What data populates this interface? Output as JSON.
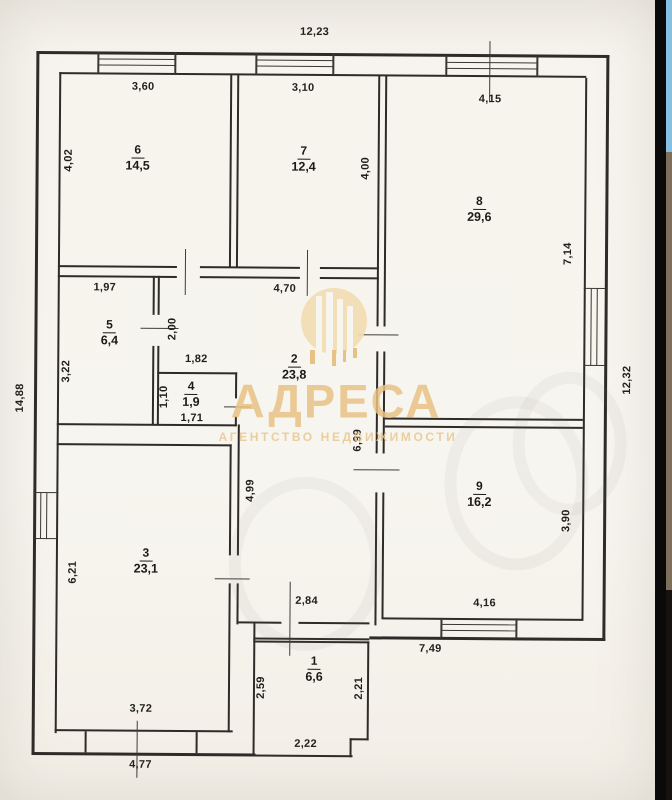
{
  "photo": {
    "type": "floor-plan-scan",
    "overall_dimensions": {
      "top": "12,23",
      "left": "14,88",
      "right": "12,32"
    }
  },
  "watermark": {
    "title": "АДРЕСА",
    "subtitle": "АГЕНТСТВО НЕДВИЖИМОСТИ",
    "color": "#e8c285",
    "disc": {
      "x": 301,
      "y": 288,
      "size": 66,
      "fill": "#f2ddb0"
    },
    "white_bars": [
      [
        316,
        296,
        6,
        72
      ],
      [
        326,
        292,
        7,
        76
      ],
      [
        337,
        299,
        6,
        69
      ],
      [
        347,
        306,
        6,
        62
      ]
    ],
    "gold_bars": [
      [
        310,
        350,
        5,
        14
      ],
      [
        332,
        350,
        4,
        16
      ],
      [
        343,
        350,
        3,
        12
      ],
      [
        353,
        348,
        4,
        10
      ]
    ]
  },
  "floor_plan": {
    "rooms": [
      {
        "number": "6",
        "area": "14,5",
        "x": 136,
        "y": 158
      },
      {
        "number": "7",
        "area": "12,4",
        "x": 302,
        "y": 158
      },
      {
        "number": "8",
        "area": "29,6",
        "x": 478,
        "y": 207
      },
      {
        "number": "5",
        "area": "6,4",
        "x": 109,
        "y": 333
      },
      {
        "number": "4",
        "area": "1,9",
        "x": 191,
        "y": 394
      },
      {
        "number": "2",
        "area": "23,8",
        "x": 294,
        "y": 366
      },
      {
        "number": "9",
        "area": "16,2",
        "x": 480,
        "y": 492
      },
      {
        "number": "3",
        "area": "23,1",
        "x": 147,
        "y": 561
      },
      {
        "number": "1",
        "area": "6,6",
        "x": 316,
        "y": 668
      }
    ],
    "dimension_labels": [
      {
        "text": "12,23",
        "x": 312,
        "y": 32,
        "v": false
      },
      {
        "text": "3,60",
        "x": 141,
        "y": 88,
        "v": false
      },
      {
        "text": "3,10",
        "x": 301,
        "y": 88,
        "v": false
      },
      {
        "text": "4,15",
        "x": 488,
        "y": 98,
        "v": false
      },
      {
        "text": "4,02",
        "x": 67,
        "y": 162,
        "v": true
      },
      {
        "text": "4,00",
        "x": 364,
        "y": 168,
        "v": true
      },
      {
        "text": "7,14",
        "x": 567,
        "y": 252,
        "v": true
      },
      {
        "text": "12,32",
        "x": 627,
        "y": 378,
        "v": true
      },
      {
        "text": "14,88",
        "x": 20,
        "y": 400,
        "v": true
      },
      {
        "text": "1,97",
        "x": 104,
        "y": 289,
        "v": false
      },
      {
        "text": "3,22",
        "x": 66,
        "y": 373,
        "v": true
      },
      {
        "text": "2,00",
        "x": 172,
        "y": 330,
        "v": true
      },
      {
        "text": "1,82",
        "x": 196,
        "y": 360,
        "v": false
      },
      {
        "text": "1,10",
        "x": 164,
        "y": 398,
        "v": true
      },
      {
        "text": "1,71",
        "x": 192,
        "y": 419,
        "v": false
      },
      {
        "text": "4,70",
        "x": 284,
        "y": 289,
        "v": false
      },
      {
        "text": "6,99",
        "x": 358,
        "y": 440,
        "v": true
      },
      {
        "text": "4,99",
        "x": 251,
        "y": 491,
        "v": true
      },
      {
        "text": "3,90",
        "x": 567,
        "y": 519,
        "v": true
      },
      {
        "text": "6,21",
        "x": 74,
        "y": 574,
        "v": true
      },
      {
        "text": "2,84",
        "x": 308,
        "y": 601,
        "v": false
      },
      {
        "text": "4,16",
        "x": 486,
        "y": 602,
        "v": false
      },
      {
        "text": "7,49",
        "x": 432,
        "y": 648,
        "v": false
      },
      {
        "text": "2,59",
        "x": 263,
        "y": 688,
        "v": true
      },
      {
        "text": "2,21",
        "x": 361,
        "y": 688,
        "v": true
      },
      {
        "text": "2,22",
        "x": 308,
        "y": 744,
        "v": false
      },
      {
        "text": "3,72",
        "x": 143,
        "y": 710,
        "v": false
      },
      {
        "text": "4,77",
        "x": 143,
        "y": 766,
        "v": false
      }
    ],
    "walls": [
      [
        34,
        53,
        573,
        3
      ],
      [
        57,
        74,
        527,
        2
      ],
      [
        34,
        53,
        3,
        704
      ],
      [
        57,
        74,
        2,
        661
      ],
      [
        604,
        53,
        3,
        586
      ],
      [
        583,
        76,
        2,
        543
      ],
      [
        34,
        754,
        224,
        3
      ],
      [
        57,
        731,
        178,
        2
      ],
      [
        371,
        636,
        236,
        3
      ],
      [
        383,
        617,
        201,
        2
      ],
      [
        228,
        75,
        2,
        193
      ],
      [
        235,
        75,
        2,
        193
      ],
      [
        376,
        75,
        2,
        251
      ],
      [
        376,
        351,
        2,
        102
      ],
      [
        376,
        492,
        2,
        133
      ],
      [
        383,
        75,
        2,
        251
      ],
      [
        383,
        351,
        2,
        102
      ],
      [
        383,
        492,
        2,
        126
      ],
      [
        57,
        267,
        119,
        2
      ],
      [
        199,
        267,
        100,
        2
      ],
      [
        319,
        267,
        59,
        2
      ],
      [
        57,
        277,
        119,
        2
      ],
      [
        199,
        277,
        100,
        2
      ],
      [
        319,
        277,
        59,
        2
      ],
      [
        152,
        277,
        2,
        39
      ],
      [
        152,
        347,
        2,
        79
      ],
      [
        157,
        277,
        2,
        39
      ],
      [
        157,
        347,
        2,
        79
      ],
      [
        57,
        425,
        180,
        2
      ],
      [
        57,
        445,
        175,
        2
      ],
      [
        230,
        445,
        2,
        111
      ],
      [
        230,
        584,
        2,
        149
      ],
      [
        238,
        425,
        2,
        131
      ],
      [
        238,
        584,
        2,
        41
      ],
      [
        157,
        373,
        80,
        1.6
      ],
      [
        235,
        373,
        1.6,
        26
      ],
      [
        235,
        417,
        1.6,
        10
      ],
      [
        385,
        417,
        198,
        2
      ],
      [
        385,
        425,
        198,
        2
      ],
      [
        240,
        622,
        43,
        2
      ],
      [
        300,
        622,
        71,
        2
      ],
      [
        255,
        638,
        116,
        2
      ],
      [
        255,
        641,
        116,
        1.6
      ],
      [
        255,
        622,
        2,
        135
      ],
      [
        369,
        641,
        2,
        99
      ],
      [
        255,
        755,
        100,
        2
      ],
      [
        352,
        738,
        2,
        19
      ],
      [
        352,
        738,
        19,
        2
      ],
      [
        87,
        733,
        1.6,
        21
      ],
      [
        198,
        733,
        1.6,
        21
      ]
    ],
    "windows": [
      [
        95,
        53,
        2,
        22
      ],
      [
        172,
        53,
        2,
        22
      ],
      [
        96,
        60,
        77,
        1.4
      ],
      [
        96,
        66,
        77,
        1.4
      ],
      [
        253,
        53,
        2,
        22
      ],
      [
        330,
        53,
        2,
        22
      ],
      [
        254,
        60,
        77,
        1.4
      ],
      [
        254,
        66,
        77,
        1.4
      ],
      [
        443,
        55,
        2,
        21
      ],
      [
        534,
        55,
        2,
        21
      ],
      [
        444,
        61,
        91,
        1.4
      ],
      [
        444,
        67,
        91,
        1.4
      ],
      [
        583,
        286,
        22,
        1.4
      ],
      [
        583,
        363,
        22,
        1.4
      ],
      [
        590,
        287,
        1.4,
        77
      ],
      [
        596,
        287,
        1.4,
        77
      ],
      [
        34,
        494,
        23,
        1.4
      ],
      [
        34,
        540,
        23,
        1.4
      ],
      [
        41,
        495,
        1.4,
        46
      ],
      [
        47,
        495,
        1.4,
        46
      ],
      [
        442,
        617,
        2,
        20
      ],
      [
        517,
        617,
        2,
        20
      ],
      [
        443,
        623,
        75,
        1.4
      ],
      [
        443,
        629,
        75,
        1.4
      ]
    ],
    "ticks": [
      [
        184,
        250,
        1.4,
        46
      ],
      [
        306,
        250,
        1.4,
        46
      ],
      [
        140,
        329,
        38,
        1.4
      ],
      [
        224,
        407,
        27,
        1.4
      ],
      [
        358,
        334,
        40,
        1.4
      ],
      [
        354,
        469,
        46,
        1.4
      ],
      [
        216,
        579,
        35,
        1.4
      ],
      [
        291,
        582,
        1.4,
        74
      ],
      [
        487,
        40,
        1.4,
        61
      ],
      [
        139,
        722,
        1.4,
        57
      ]
    ],
    "ghost_marks": [
      {
        "x": 505,
        "y": 470,
        "w": 120,
        "h": 150
      },
      {
        "x": 295,
        "y": 552,
        "w": 130,
        "h": 150
      },
      {
        "x": 558,
        "y": 430,
        "w": 90,
        "h": 120
      }
    ]
  },
  "carousel_strip": {
    "divider_color": "#0a0a0a",
    "divider_x": 655,
    "divider_w": 11,
    "sliver_x": 666,
    "sliver_w": 6,
    "sections": [
      {
        "color": "#85bfe2",
        "y": 0,
        "h": 152
      },
      {
        "color": "#7d6f5b",
        "y": 152,
        "h": 438
      },
      {
        "color": "#15120f",
        "y": 590,
        "h": 210
      }
    ]
  }
}
